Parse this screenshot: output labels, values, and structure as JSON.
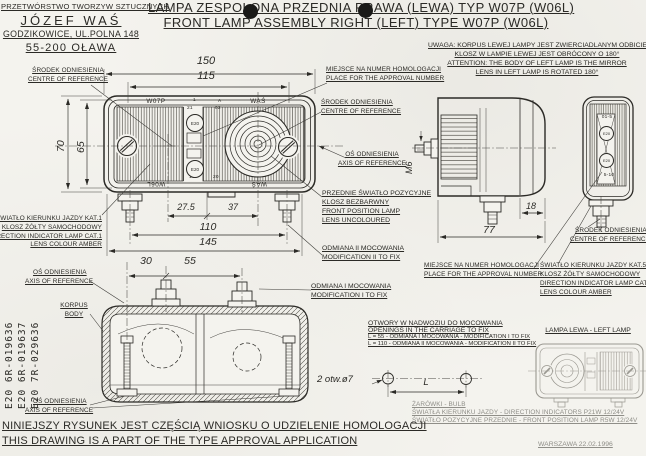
{
  "company": {
    "l1": "PRZETWÓRSTWO TWORZYW SZTUCZNYCH",
    "l2": "JÓZEF WAŚ",
    "l3": "GODZIKOWICE, UL.POLNA 148",
    "l4": "55-200 OŁAWA"
  },
  "title": {
    "pl": "LAMPA ZESPOLONA PRZEDNIA PRAWA (LEWA) TYP W07P (W06L)",
    "en": "FRONT LAMP ASSEMBLY RIGHT (LEFT) TYPE W07P (W06L)"
  },
  "attention": {
    "l1": "UWAGA: KORPUS LEWEJ LAMPY JEST ZWIERCIADLANYM ODBICIEM",
    "l2": "KLOSZ W LAMPIE LEWEJ JEST OBRÓCONY O 180°",
    "l3": "ATTENTION: THE BODY OF LEFT LAMP IS THE MIRROR",
    "l4": "LENS IN LEFT LAMP IS ROTATED 180°"
  },
  "labels": {
    "centre_ref": {
      "pl": "ŚRODEK ODNIESIENIA",
      "en": "CENTRE OF REFERENCE"
    },
    "axis_ref": {
      "pl": "OŚ ODNIESIENIA",
      "en": "AXIS OF REFERENCE"
    },
    "approval": {
      "pl": "MIEJSCE NA NUMER HOMOLOGACJI",
      "en": "PLACE FOR THE APPROVAL NUMBER"
    },
    "body": {
      "pl": "KORPUS",
      "en": "BODY"
    },
    "mod1": {
      "pl": "ODMIANA I MOCOWANIA",
      "en": "MODIFICATION I TO FIX"
    },
    "mod2": {
      "pl": "ODMIANA II MOCOWANIA",
      "en": "MODIFICATION II TO FIX"
    },
    "position_lamp": {
      "l1": "PRZEDNIE ŚWIATŁO POZYCYJNE",
      "l2": "KLOSZ BEZBARWNY",
      "l3": "FRONT POSITION LAMP",
      "l4": "LENS UNCOLOURED"
    },
    "indicator1": {
      "l1": "ŚWIATŁO KIERUNKU JAZDY KAT.1",
      "l2": "KLOSZ ŻÓŁTY SAMOCHODOWY",
      "l3": "DIRECTION INDICATOR LAMP CAT.1",
      "l4": "LENS COLOUR AMBER"
    },
    "indicator5": {
      "l1": "ŚWIATŁO KIERUNKU JAZDY KAT.5",
      "l2": "KLOSZ ŻÓŁTY SAMOCHODOWY",
      "l3": "DIRECTION INDICATOR LAMP CAT.5",
      "l4": "LENS COLOUR AMBER"
    },
    "openings": {
      "l1": "OTWORY W NADWOZIU DO MOCOWANIA",
      "l2": "OPENINGS IN THE CARRIAGE TO FIX",
      "l3": "L = 55 - ODMIANA I MOCOWANIA - MODIFICATION I TO FIX",
      "l4": "L = 110 - ODMIANA II MOCOWANIA - MODIFICATION II TO FIX"
    },
    "left_lamp": "LAMPA LEWA - LEFT LAMP",
    "holes": "2 otw.ø7"
  },
  "approvals": {
    "n1": "E20 6R-019636",
    "n2": "E20 6R-019637",
    "n3": "E20 7R-029636"
  },
  "bulbs": {
    "l1": "ŻARÓWKI - BULB",
    "l2": "ŚWIATŁA KIERUNKU JAZDY - DIRECTION INDICATORS P21W 12/24V",
    "l3": "ŚWIATŁO POZYCYJNE PRZEDNIE - FRONT POSITION LAMP R5W 12/24V"
  },
  "footer": {
    "pl": "NINIEJSZY RYSUNEK JEST CZĘŚCIĄ WNIOSKU O UDZIELENIE HOMOLOGACJI",
    "en": "THIS DRAWING IS A PART OF THE TYPE APPROVAL APPLICATION",
    "place_date": "WARSZAWA 22.02.1996"
  },
  "dims": {
    "d150": "150",
    "d115": "115",
    "d70": "70",
    "d65": "65",
    "d27_5": "27.5",
    "d37": "37",
    "d110": "110",
    "d145": "145",
    "d30": "30",
    "d55": "55",
    "d18": "18",
    "d77": "77",
    "m6": "M6",
    "L": "L"
  },
  "marks": {
    "w07p": "W07P",
    "was": "WAŚ",
    "w06l": "W06L",
    "m1": "1",
    "mA": "A",
    "m21": "21",
    "m02": "02",
    "m20": "20",
    "m10": "10",
    "e20": "E20",
    "rear_top": "01-5",
    "rear_bottom": "5-10"
  }
}
